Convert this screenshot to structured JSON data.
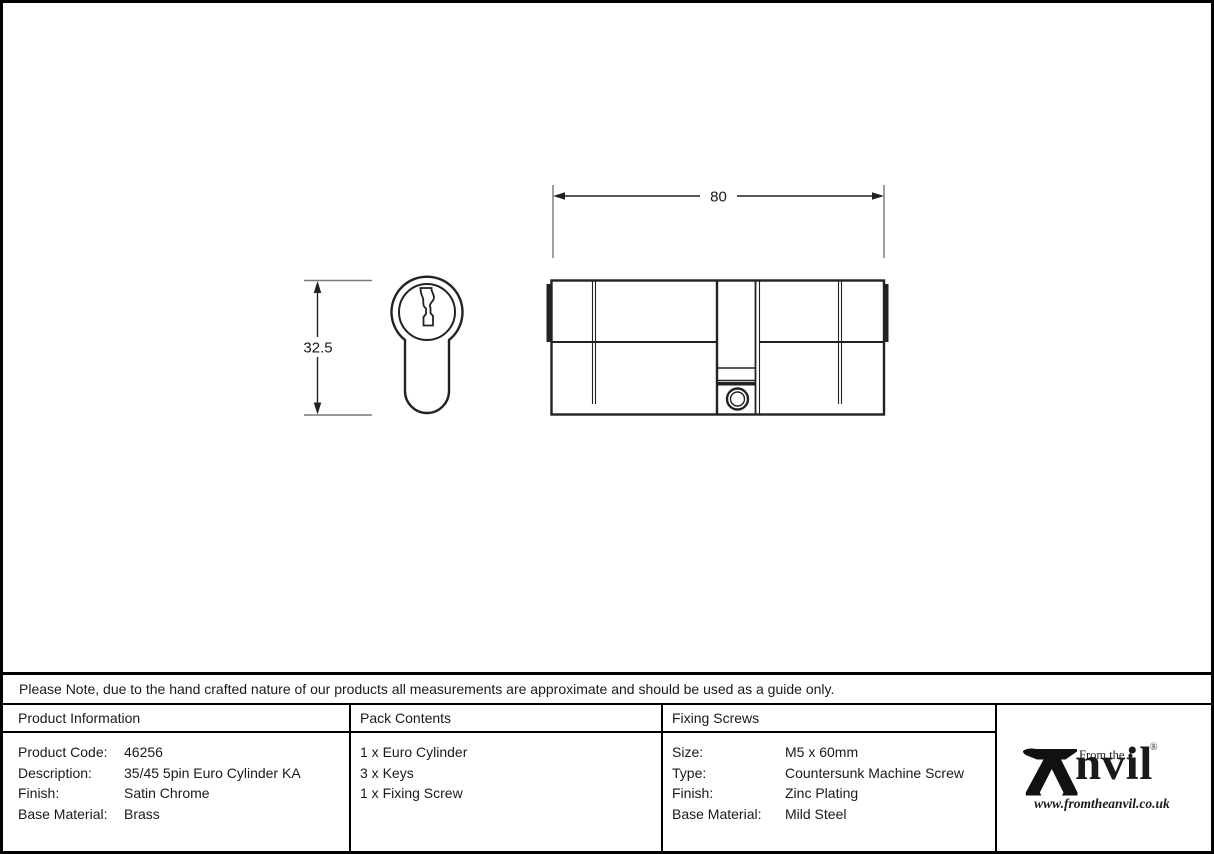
{
  "drawing": {
    "width_dim_label": "80",
    "height_dim_label": "32.5"
  },
  "note": {
    "text": "Please Note, due to the hand crafted nature of our products all measurements are approximate and should be used as a guide only."
  },
  "product_info": {
    "header": "Product Information",
    "rows": [
      {
        "label": "Product Code:",
        "value": "46256"
      },
      {
        "label": "Description:",
        "value": "35/45 5pin Euro Cylinder KA"
      },
      {
        "label": "Finish:",
        "value": "Satin Chrome"
      },
      {
        "label": "Base Material:",
        "value": "Brass"
      }
    ]
  },
  "pack_contents": {
    "header": "Pack Contents",
    "items": [
      "1 x Euro Cylinder",
      "3 x Keys",
      "1 x Fixing Screw"
    ]
  },
  "fixing_screws": {
    "header": "Fixing Screws",
    "rows": [
      {
        "label": "Size:",
        "value": "M5 x 60mm"
      },
      {
        "label": "Type:",
        "value": "Countersunk Machine Screw"
      },
      {
        "label": "Finish:",
        "value": "Zinc Plating"
      },
      {
        "label": "Base Material:",
        "value": "Mild Steel"
      }
    ]
  },
  "logo": {
    "brand_rest": "nvil",
    "tagline": "From the",
    "diamond": "♦",
    "registered": "®",
    "website": "www.fromtheanvil.co.uk"
  },
  "colors": {
    "line": "#222222",
    "extension_line": "#787878",
    "text": "#1a1a1a",
    "border": "#000000"
  }
}
